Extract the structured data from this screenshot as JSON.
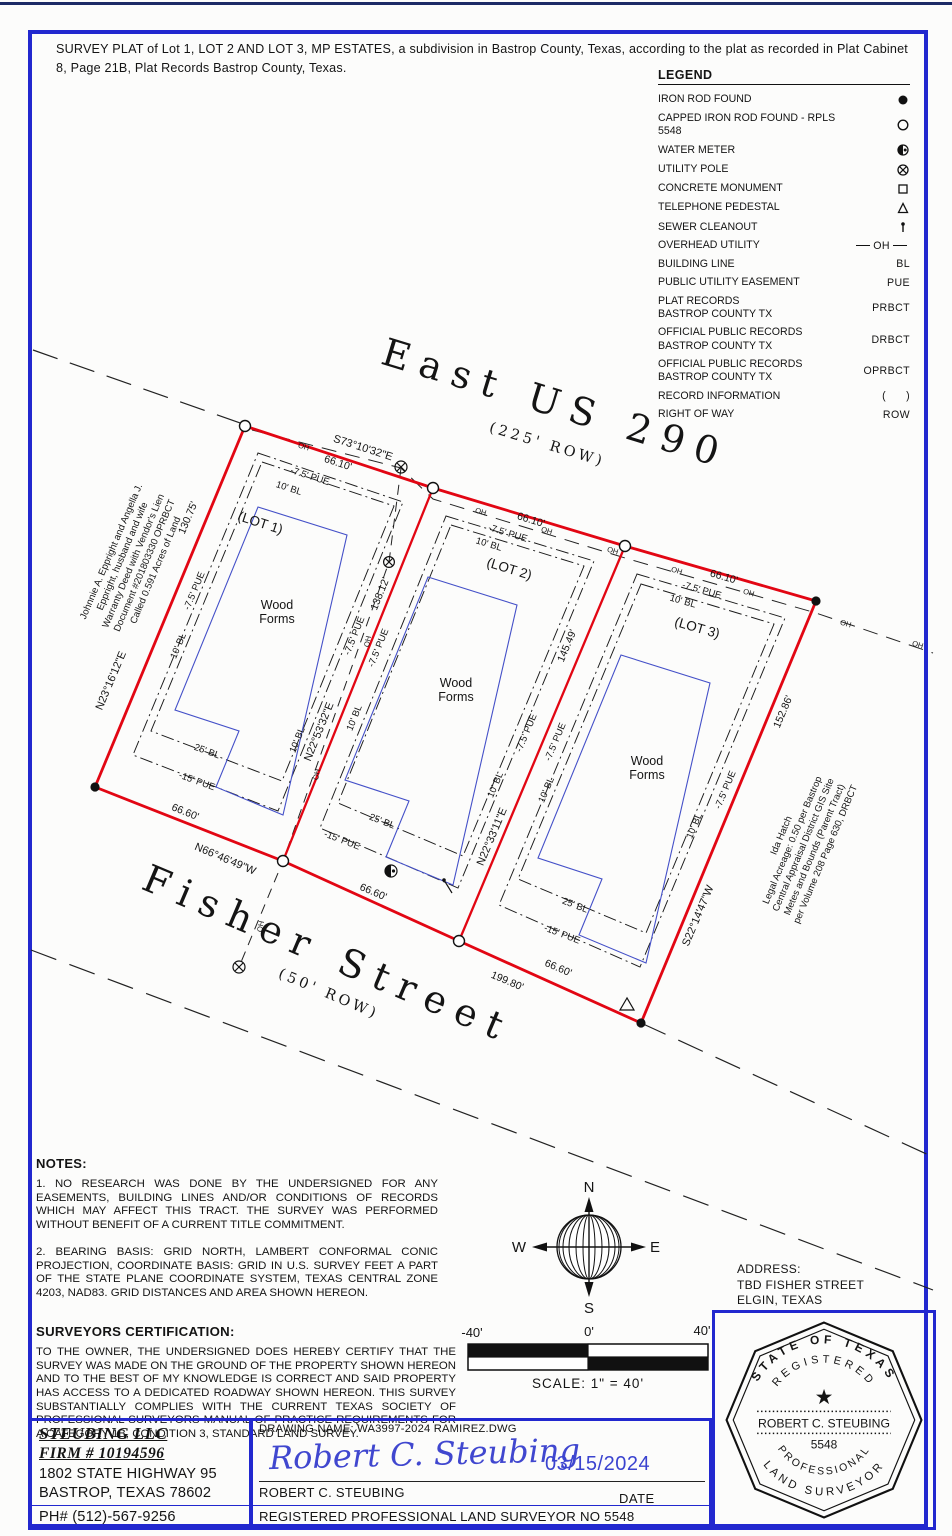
{
  "header": {
    "title": "SURVEY PLAT of Lot 1, LOT 2 AND LOT 3, MP ESTATES, a subdivision in Bastrop County, Texas, according to the plat as recorded in Plat Cabinet 8, Page 21B, Plat Records Bastrop County, Texas."
  },
  "legend": {
    "title": "LEGEND",
    "items": [
      {
        "label": "IRON ROD FOUND",
        "symbol": "iron-rod-found"
      },
      {
        "label": "CAPPED IRON ROD FOUND - RPLS 5548",
        "symbol": "capped-iron-rod"
      },
      {
        "label": "WATER METER",
        "symbol": "water-meter"
      },
      {
        "label": "UTILITY POLE",
        "symbol": "utility-pole"
      },
      {
        "label": "CONCRETE MONUMENT",
        "symbol": "concrete-monument"
      },
      {
        "label": "TELEPHONE PEDESTAL",
        "symbol": "telephone-pedestal"
      },
      {
        "label": "SEWER CLEANOUT",
        "symbol": "sewer-cleanout"
      },
      {
        "label": "OVERHEAD UTILITY",
        "abbr": "OH"
      },
      {
        "label": "BUILDING LINE",
        "abbr": "BL"
      },
      {
        "label": "PUBLIC UTILITY EASEMENT",
        "abbr": "PUE"
      },
      {
        "label": "PLAT RECORDS\nBASTROP COUNTY TX",
        "abbr": "PRBCT"
      },
      {
        "label": "OFFICIAL PUBLIC RECORDS\nBASTROP COUNTY TX",
        "abbr": "DRBCT"
      },
      {
        "label": "OFFICIAL PUBLIC RECORDS\nBASTROP COUNTY TX",
        "abbr": "OPRBCT"
      },
      {
        "label": "RECORD INFORMATION",
        "abbr": "(      )"
      },
      {
        "label": "RIGHT OF WAY",
        "abbr": "ROW"
      }
    ]
  },
  "plat": {
    "highway": {
      "name": "East US 290",
      "row": "(225' ROW)"
    },
    "street": {
      "name": "Fisher Street",
      "row": "(50' ROW)"
    },
    "lots": {
      "lot1": "(LOT 1)",
      "lot2": "(LOT 2)",
      "lot3": "(LOT 3)"
    },
    "wood": {
      "line1": "Wood",
      "line2": "Forms"
    },
    "dims": {
      "front": "66.10'",
      "rear": "66.60'",
      "total_frontage": "199.80'",
      "west": "130.75'",
      "interior1": "138.12'",
      "interior2": "145.49'",
      "east": "152.86'"
    },
    "bearings": {
      "highway": "S73°10'32\"E",
      "west": "N23°16'12\"E",
      "interior1": "N22°53'32\"E",
      "interior2": "N22°33'11\"E",
      "east": "S22°14'47\"W",
      "street": "N66°46'49\"W"
    },
    "easements": {
      "pue_front": "-7.5' PUE",
      "bl_front": "10' BL",
      "bl_side": "10' BL",
      "bl_rear": "25' BL",
      "pue_rear": "-15' PUE"
    },
    "oh_label": "OH",
    "owner_tract": {
      "lines": [
        "Johnnie A. Eppright and Angella J.",
        "Eppright, husband and wife",
        "Warranty Deed with Vendor's Lien",
        "Document #201803330 OPRBCT",
        "Called 0.591 Acres of Land"
      ]
    },
    "adjacent_tract": {
      "lines": [
        "Ida Hatch",
        "Legal Acreage: 0.50 per Bastrop",
        "Central Appraisal District GIS Site",
        "Metes and Bounds (Parent Tract)",
        "per Volume 208 Page 630, DRBCT"
      ]
    }
  },
  "notes": {
    "heading": "NOTES:",
    "note1": "1.  NO RESEARCH WAS DONE BY THE UNDERSIGNED FOR ANY EASEMENTS, BUILDING LINES AND/OR CONDITIONS OF RECORDS WHICH MAY AFFECT THIS TRACT. THE SURVEY WAS PERFORMED WITHOUT BENEFIT OF A CURRENT TITLE COMMITMENT.",
    "note2": "2.  BEARING BASIS: GRID NORTH, LAMBERT CONFORMAL CONIC PROJECTION, COORDINATE BASIS: GRID IN U.S. SURVEY FEET A PART OF THE STATE PLANE COORDINATE SYSTEM, TEXAS CENTRAL ZONE 4203, NAD83. GRID DISTANCES AND AREA SHOWN HEREON."
  },
  "certification": {
    "heading": "SURVEYORS CERTIFICATION:",
    "body": "TO THE OWNER, THE UNDERSIGNED DOES HEREBY CERTIFY THAT THE SURVEY WAS MADE ON THE GROUND OF THE PROPERTY SHOWN HEREON AND TO THE BEST OF MY KNOWLEDGE IS CORRECT AND SAID PROPERTY HAS ACCESS TO A DEDICATED ROADWAY SHOWN HEREON. THIS SURVEY SUBSTANTIALLY COMPLIES WITH THE CURRENT TEXAS SOCIETY OF PROFESSIONAL SURVEYORS MANUAL OF PRACTICE REQUIREMENTS FOR A CATEGORY 1B, CONDITION 3, STANDARD LAND SURVEY."
  },
  "compass": {
    "n": "N",
    "s": "S",
    "e": "E",
    "w": "W"
  },
  "scale_bar": {
    "left": "-40'",
    "center": "0'",
    "right": "40'",
    "caption": "SCALE: 1\" = 40'"
  },
  "address": {
    "heading": "ADDRESS:",
    "line1": "TBD FISHER STREET",
    "line2": "ELGIN, TEXAS"
  },
  "firm": {
    "name": "STEUBING LLC",
    "firm_number": "FIRM # 10194596",
    "address_line1": "1802 STATE HIGHWAY 95",
    "address_line2": "BASTROP, TEXAS 78602",
    "phone": "PH# (512)-567-9256"
  },
  "signature_block": {
    "drawing_name_label": "DRAWING NAME: WA3997-2024 RAMIREZ.DWG",
    "signature": "Robert C. Steubing",
    "date": "03/15/2024",
    "surveyor_name": "ROBERT C. STEUBING",
    "date_label": "DATE",
    "registration": "REGISTERED PROFESSIONAL LAND SURVEYOR NO 5548"
  },
  "seal": {
    "arc_top": "STATE OF TEXAS",
    "arc_registered": "REGISTERED",
    "star": "★",
    "name": "ROBERT C. STEUBING",
    "number": "5548",
    "arc_professional": "PROFESSIONAL",
    "arc_land_surveyor": "LAND SURVEYOR"
  }
}
